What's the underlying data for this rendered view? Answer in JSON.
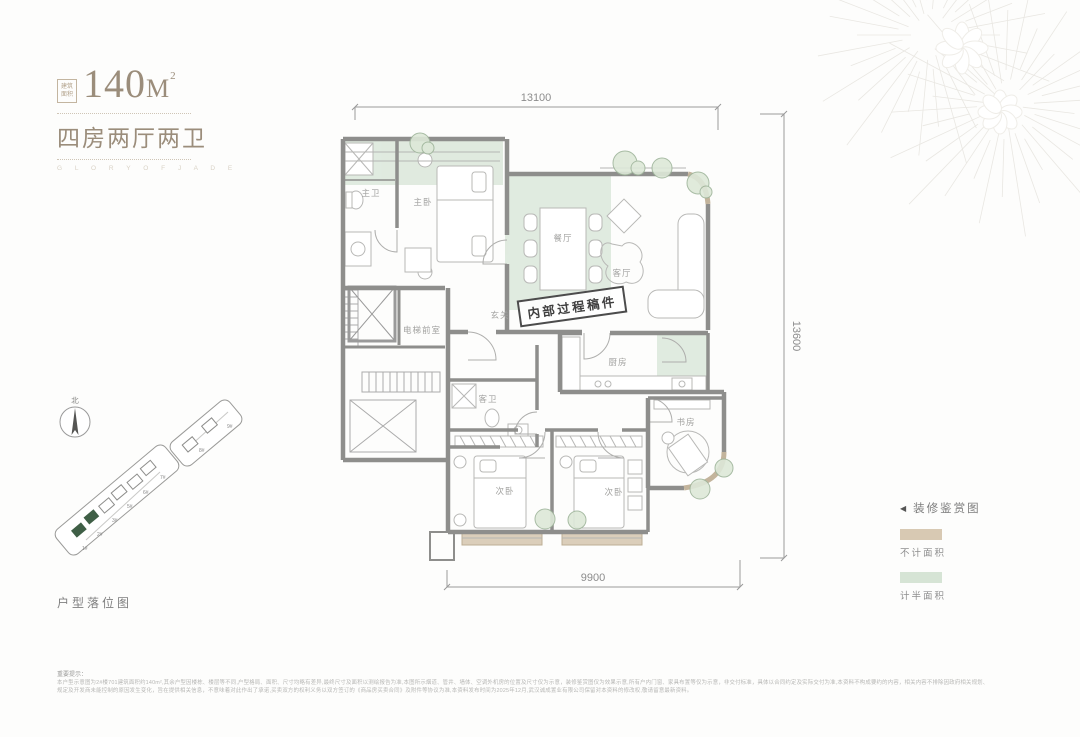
{
  "header": {
    "seal_line1": "建筑",
    "seal_line2": "面积",
    "area_value": "140",
    "area_unit": "M",
    "area_sup": "2",
    "title": "四房两厅两卫",
    "subtitle_en": "G L O R Y   O F   J A D E"
  },
  "plan": {
    "stamp": "内部过程稿件",
    "dimensions": {
      "top": "13100",
      "right": "13600",
      "bottom": "9900"
    },
    "rooms": [
      {
        "label": "主卫"
      },
      {
        "label": "主卧"
      },
      {
        "label": "餐厅"
      },
      {
        "label": "客厅"
      },
      {
        "label": "玄关"
      },
      {
        "label": "电梯前室"
      },
      {
        "label": "厨房"
      },
      {
        "label": "客卫"
      },
      {
        "label": "次卧"
      },
      {
        "label": "次卧"
      },
      {
        "label": "书房"
      }
    ],
    "colors": {
      "wall": "#8e8e8c",
      "half_area_green": "#d9e5d7",
      "no_count_tan": "#d9cbb6",
      "furniture_line": "#b8b8b6",
      "corner_wall_tan": "#c3b49c"
    }
  },
  "legend": {
    "title": "装修鉴赏图",
    "items": [
      {
        "label": "不计面积",
        "color": "#d8c9b3"
      },
      {
        "label": "计半面积",
        "color": "#d6e4d5"
      }
    ]
  },
  "site_plan": {
    "label": "户型落位图",
    "compass": "北",
    "buildings": [
      "1#",
      "2#",
      "3#",
      "5#",
      "6#",
      "7#",
      "8#",
      "9#"
    ]
  },
  "disclaimer": {
    "title": "重要提示：",
    "line1": "本户型示意图为2#楼701建筑面积约140m²,其余户型因楼栋、楼层等不同,户型格局、面积、尺寸均略有差异,最终尺寸及面积以测绘报告为准,本图所示烟道、管井、墙体、空调外机房的位置及尺寸仅为示意，装修鉴赏图仅为效果示意,所有户内门窗、家具布置等仅为示意，非交付标准，具体以合同约定及实际交付为准,本资料不构成要约的内容，相关内容不排除因政府相关规划、",
    "line2": "规定及开发商未能控制的原因发生变化，旨在提供相关信息，不意味着对此作出了承诺,买卖双方的权利义务以双方签订的《商品房买卖合同》及附件等协议为准,本资料发布时间为2025年12月,武汉诚成置业有限公司保留对本资料的修改权,敬请留意最新资料。"
  }
}
